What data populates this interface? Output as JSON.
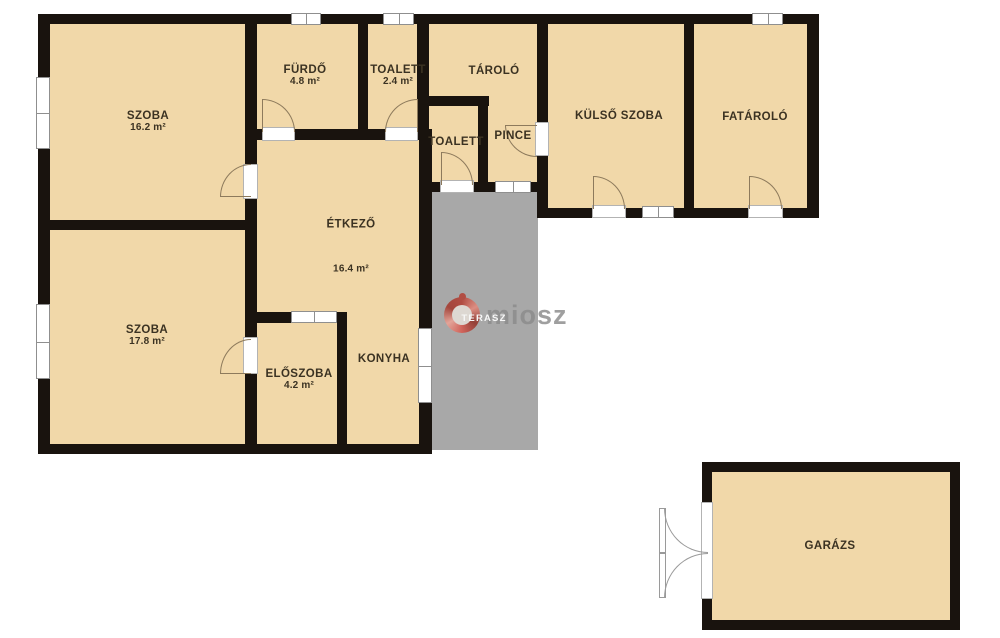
{
  "floorplan": {
    "rooms": [
      {
        "name": "SZOBA",
        "area": "16.2 m²"
      },
      {
        "name": "FÜRDŐ",
        "area": "4.8 m²"
      },
      {
        "name": "TOALETT",
        "area": "2.4 m²"
      },
      {
        "name": "TÁROLÓ",
        "area": ""
      },
      {
        "name": "TOALETT",
        "area": ""
      },
      {
        "name": "PINCE",
        "area": ""
      },
      {
        "name": "KÜLSŐ SZOBA",
        "area": ""
      },
      {
        "name": "FATÁROLÓ",
        "area": ""
      },
      {
        "name": "ÉTKEZŐ",
        "area": "16.4 m²"
      },
      {
        "name": "SZOBA",
        "area": "17.8 m²"
      },
      {
        "name": "ELŐSZOBA",
        "area": "4.2 m²"
      },
      {
        "name": "KONYHA",
        "area": ""
      },
      {
        "name": "TERASZ",
        "area": ""
      },
      {
        "name": "GARÁZS",
        "area": ""
      }
    ],
    "watermark": {
      "brand": "miosz"
    },
    "colors": {
      "room_fill": "#f1d8a9",
      "wall": "#19130e",
      "terrace": "#a8a8a8",
      "logo_red": "#b43a2e",
      "watermark_text": "#8b8b8b"
    }
  }
}
